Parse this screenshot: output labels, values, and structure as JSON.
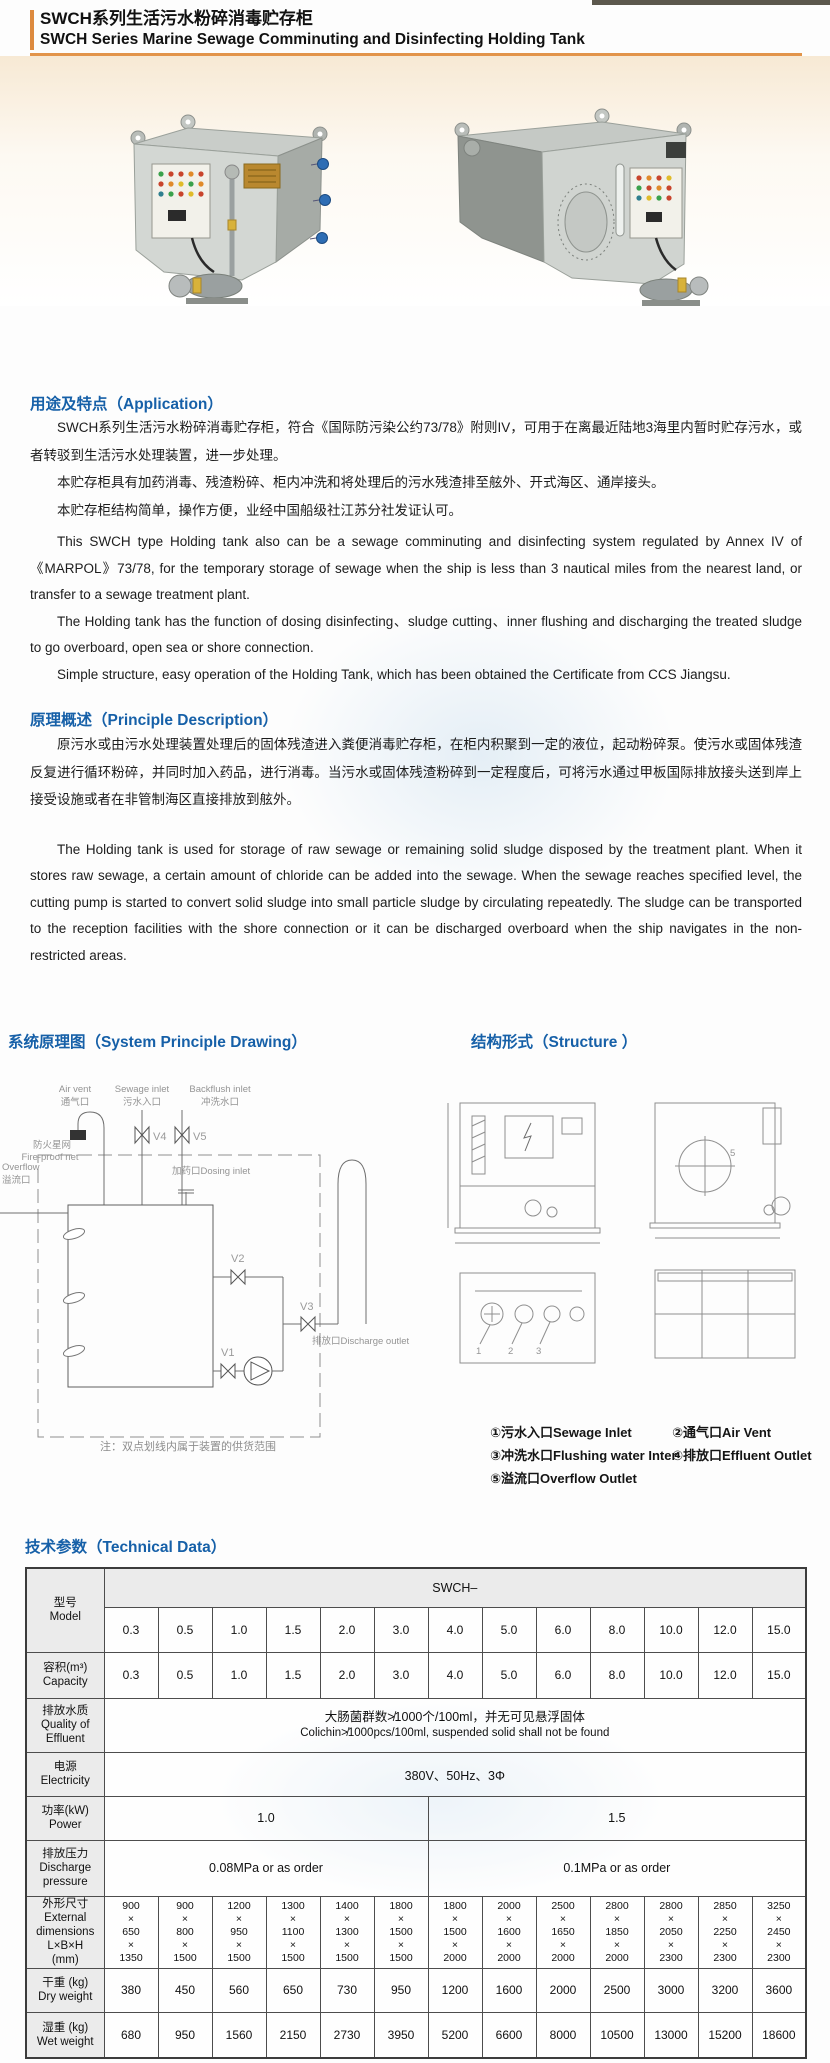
{
  "header": {
    "title_zh": "SWCH系列生活污水粉碎消毒贮存柜",
    "title_en": "SWCH Series Marine Sewage Comminuting and Disinfecting Holding Tank"
  },
  "application": {
    "heading": "用途及特点（Application）",
    "zh": [
      "SWCH系列生活污水粉碎消毒贮存柜，符合《国际防污染公约73/78》附则IV，可用于在离最近陆地3海里内暂时贮存污水，或者转驳到生活污水处理装置，进一步处理。",
      "本贮存柜具有加药消毒、残渣粉碎、柜内冲洗和将处理后的污水残渣排至舷外、开式海区、通岸接头。",
      "本贮存柜结构简单，操作方便，业经中国船级社江苏分社发证认可。"
    ],
    "en": [
      "This SWCH type Holding tank also can be a sewage comminuting and disinfecting system regulated by Annex IV of 《MARPOL》73/78, for the temporary storage of sewage when the ship is less than 3 nautical miles from the nearest land, or transfer to a sewage treatment plant.",
      "The Holding tank has the function of dosing disinfecting、sludge cutting、inner flushing and discharging the treated sludge to go overboard, open sea or shore connection.",
      "Simple structure, easy operation of the Holding Tank, which has been obtained the Certificate from CCS Jiangsu."
    ]
  },
  "principle": {
    "heading": "原理概述（Principle Description）",
    "zh": "原污水或由污水处理装置处理后的固体残渣进入粪便消毒贮存柜，在柜内积聚到一定的液位，起动粉碎泵。使污水或固体残渣反复进行循环粉碎，并同时加入药品，进行消毒。当污水或固体残渣粉碎到一定程度后，可将污水通过甲板国际排放接头送到岸上接受设施或者在非管制海区直接排放到舷外。",
    "en": "The Holding tank is used for storage of raw sewage or remaining solid sludge disposed by the treatment plant. When it stores raw sewage, a certain amount of chloride can be added into the sewage. When the sewage reaches specified level, the cutting pump is started to convert solid sludge into small particle sludge by circulating repeatedly. The sludge can be transported to the reception facilities with the shore connection or it can be discharged overboard when the ship navigates in the non-restricted areas."
  },
  "drawing": {
    "heading": "系统原理图（System Principle Drawing）",
    "labels": {
      "air_vent_en": "Air vent",
      "air_vent_zh": "通气口",
      "sewage_inlet_en": "Sewage inlet",
      "sewage_inlet_zh": "污水入口",
      "backflush_en": "Backflush inlet",
      "backflush_zh": "冲洗水口",
      "fireproof_zh": "防火星网",
      "fireproof_en": "Fire-proof net",
      "overflow_en": "Overflow",
      "overflow_zh": "溢流口",
      "dosing": "加药口Dosing inlet",
      "v1": "V1",
      "v2": "V2",
      "v3": "V3",
      "v4": "V4",
      "v5": "V5",
      "discharge": "排放口Discharge outlet"
    },
    "note": "注：双点划线内属于装置的供货范围"
  },
  "structure": {
    "heading": "结构形式（Structure ）",
    "legend": [
      "①污水入口Sewage Inlet",
      "②通气口Air Vent",
      "③冲洗水口Flushing water Inter",
      "④排放口Effluent Outlet",
      "⑤溢流口Overflow Outlet"
    ],
    "view_labels": [
      "1",
      "2",
      "3",
      "5"
    ]
  },
  "technical": {
    "heading": "技术参数（Technical Data）",
    "series_label": "SWCH–",
    "labels": {
      "model": "型号\nModel",
      "capacity": "容积(m³)\nCapacity",
      "quality": "排放水质\nQuality of\nEffluent",
      "electricity": "电源\nElectricity",
      "power": "功率(kW)\nPower",
      "pressure": "排放压力\nDischarge\npressure",
      "dims": "外形尺寸\nExternal\ndimensions\nL×B×H\n(mm)",
      "dry": "干重 (kg)\nDry weight",
      "wet": "湿重 (kg)\nWet weight"
    },
    "models": [
      "0.3",
      "0.5",
      "1.0",
      "1.5",
      "2.0",
      "3.0",
      "4.0",
      "5.0",
      "6.0",
      "8.0",
      "10.0",
      "12.0",
      "15.0"
    ],
    "capacity": [
      "0.3",
      "0.5",
      "1.0",
      "1.5",
      "2.0",
      "3.0",
      "4.0",
      "5.0",
      "6.0",
      "8.0",
      "10.0",
      "12.0",
      "15.0"
    ],
    "quality_zh": "大肠菌群数≯1000个/100ml，并无可见悬浮固体",
    "quality_en": "Colichin≯1000pcs/100ml, suspended solid shall not be found",
    "electricity": "380V、50Hz、3Φ",
    "power_left": "1.0",
    "power_right": "1.5",
    "pressure_left": "0.08MPa or as order",
    "pressure_right": "0.1MPa or as order",
    "dims_L": [
      "900",
      "900",
      "1200",
      "1300",
      "1400",
      "1800",
      "1800",
      "2000",
      "2500",
      "2800",
      "2800",
      "2850",
      "3250"
    ],
    "dims_B": [
      "650",
      "800",
      "950",
      "1100",
      "1300",
      "1500",
      "1500",
      "1600",
      "1650",
      "1850",
      "2050",
      "2250",
      "2450"
    ],
    "dims_H": [
      "1350",
      "1500",
      "1500",
      "1500",
      "1500",
      "1500",
      "2000",
      "2000",
      "2000",
      "2000",
      "2300",
      "2300",
      "2300"
    ],
    "dry": [
      "380",
      "450",
      "560",
      "650",
      "730",
      "950",
      "1200",
      "1600",
      "2000",
      "2500",
      "3000",
      "3200",
      "3600"
    ],
    "wet": [
      "680",
      "950",
      "1560",
      "2150",
      "2730",
      "3950",
      "5200",
      "6600",
      "8000",
      "10500",
      "13000",
      "15200",
      "18600"
    ]
  }
}
